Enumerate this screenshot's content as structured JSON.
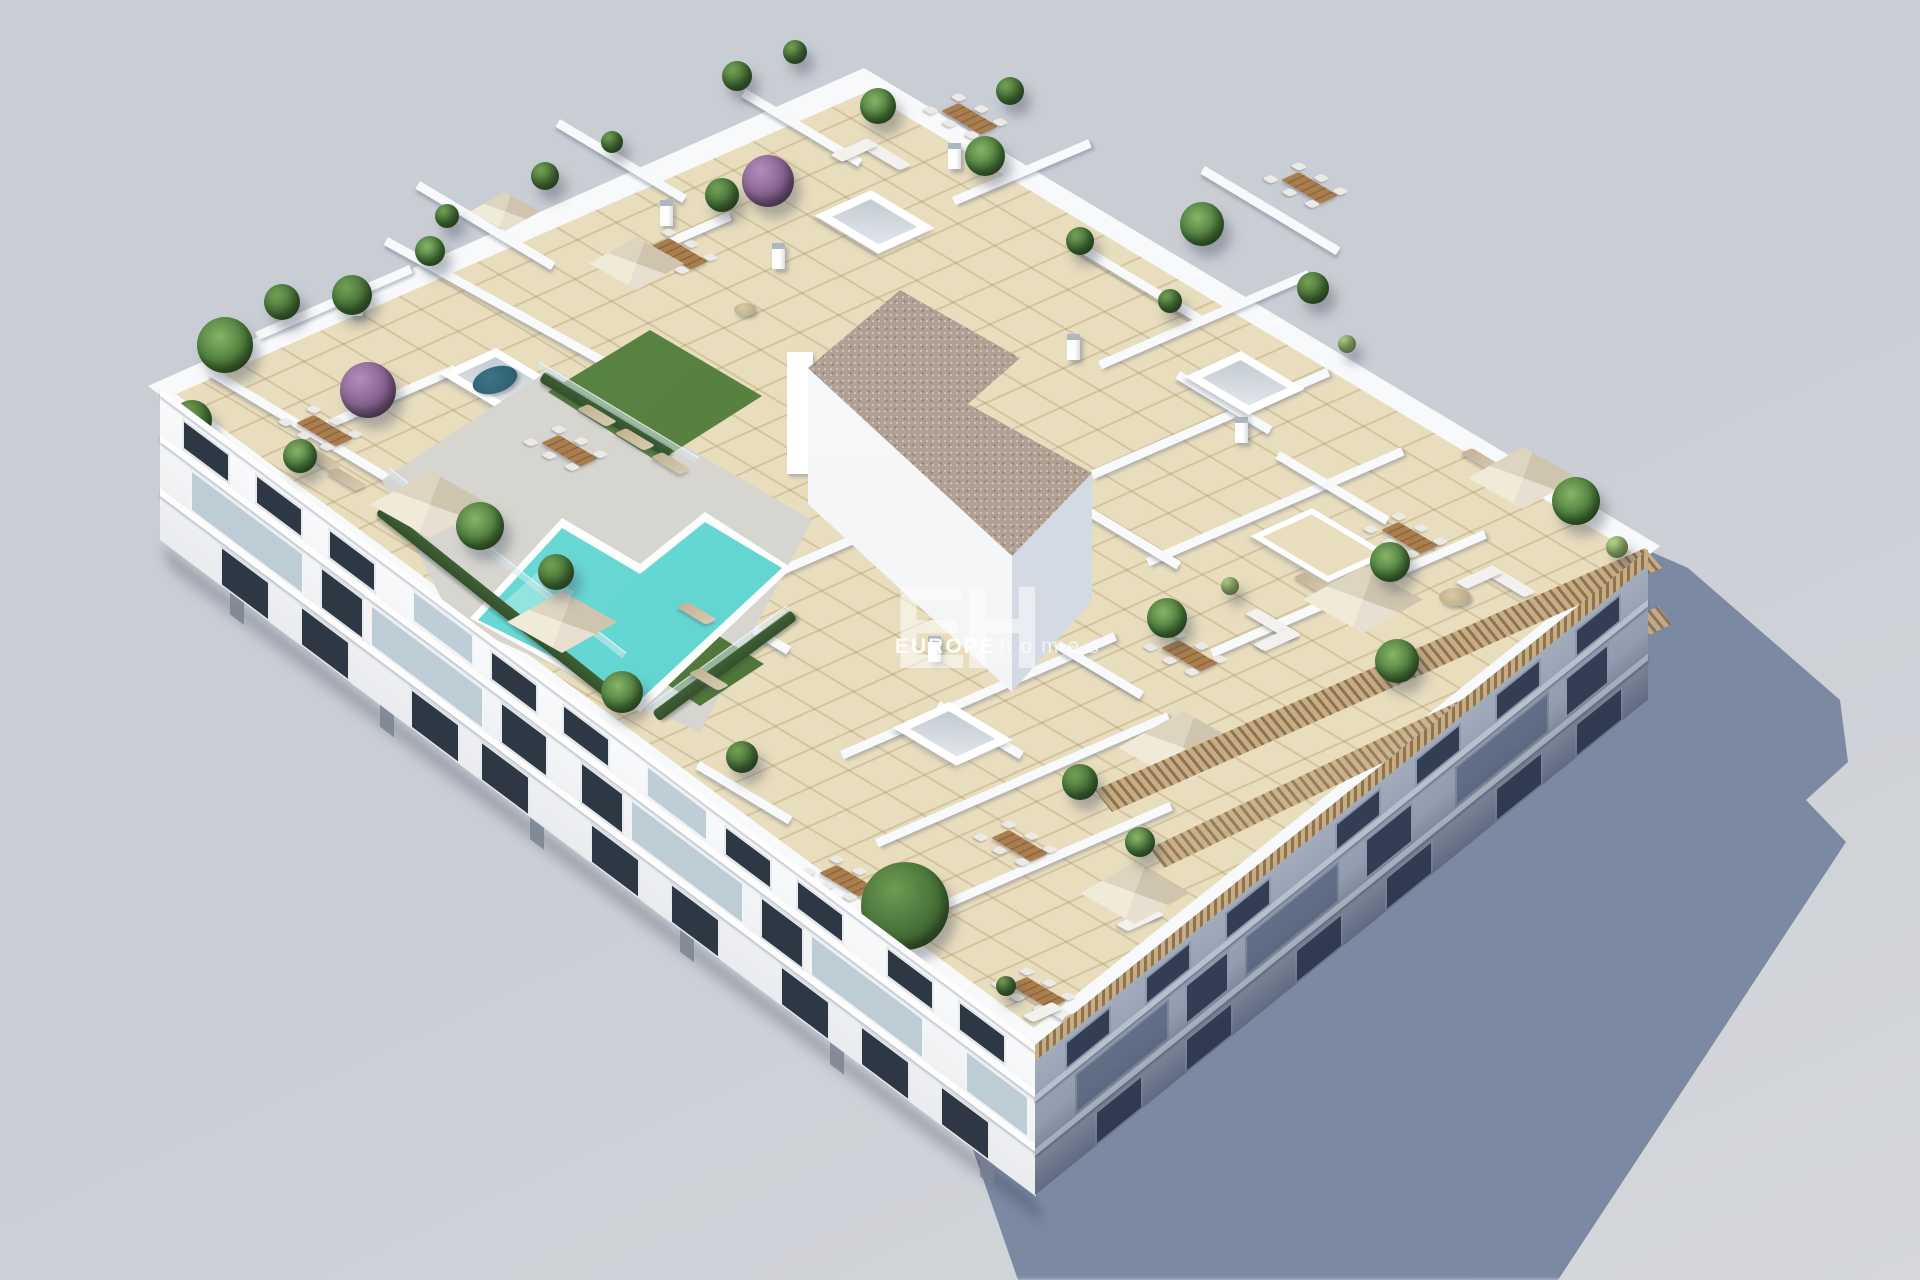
{
  "meta": {
    "description": "Aerial 3D architectural render of a white apartment building with a landscaped rooftop solarium, communal pool and private terraces, casting a long shadow to the lower right",
    "style": "architectural visualization"
  },
  "watermark": {
    "logo": "EH",
    "brand_bold": "EUROPE",
    "brand_light": "homes"
  },
  "palette": {
    "background": "#c9cdd4",
    "background_light": "#d5d7db",
    "cast_shadow": "#76839c",
    "roof_tile": "#e8ddbd",
    "wall_white": "#f8f9fa",
    "facade_shaded_top": "#a6b0c0",
    "facade_shaded_bottom": "#7f8a9e",
    "window_dark": "#2e3744",
    "window_shaded": "#333e54",
    "pool_water": "#5ad2cf",
    "pool_steps": "#92e4de",
    "deck_gray": "#d6d5d0",
    "grass_green": "#567f3f",
    "hedge_green": "#33502c",
    "gravel_roof": "#b0a093",
    "pergola_wood": "#c9ad82",
    "pergola_shadow": "#8d7352",
    "plant_green": "#3f6b34",
    "plant_light": "#8fb06a",
    "plant_purple": "#7d5a86",
    "tree_green": "#466f37",
    "wood_furniture": "#a97e4f",
    "umbrella_canvas": "#e7e0d1",
    "sofa_white": "#f2f1ed",
    "lounger_beige": "#d6c9ae",
    "glass_fence": "rgba(214,230,236,0.65)",
    "water_table": "#2b5a68"
  },
  "scene": {
    "building": {
      "label": "apartment-building",
      "stories_visible": 3,
      "roof_level": "communal rooftop solarium"
    },
    "features": [
      "rooftop-swimming-pool",
      "grass-sunbathing-areas",
      "glass-pool-fence",
      "skylights",
      "gravel-stairwell-roof",
      "private-terraces-with-white-dividing-walls",
      "canvas-parasols",
      "wooden-dining-sets",
      "outdoor-sofas",
      "sun-loungers",
      "potted-palms-and-shrubs",
      "purple-flowering-bushes",
      "wooden-pergola-on-southeast-edge",
      "balconied-white-facade",
      "shaded-southeast-facade",
      "long-cast-shadow"
    ]
  }
}
